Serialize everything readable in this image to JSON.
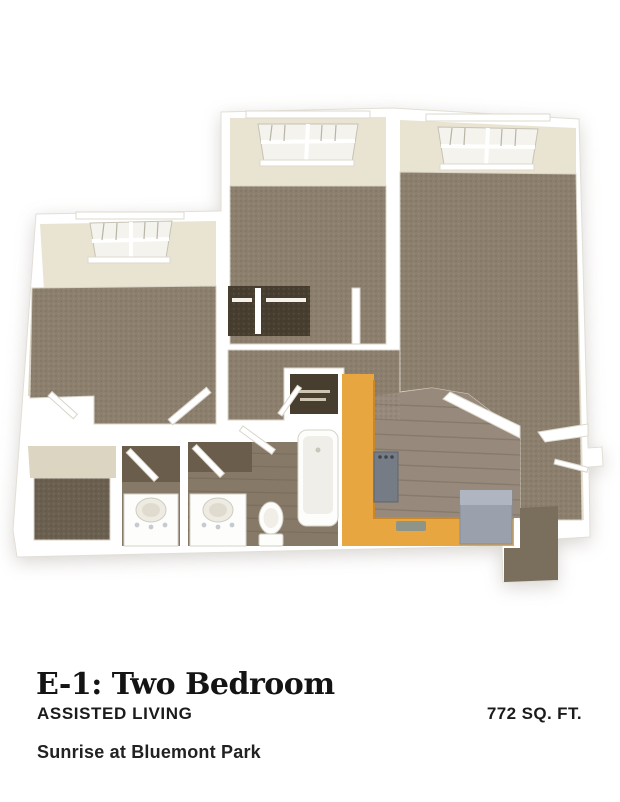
{
  "details": {
    "plan_name": "E-1: Two Bedroom",
    "plan_type": "ASSISTED LIVING",
    "area": "772 SQ. FT.",
    "community": "Sunrise at Bluemont Park"
  },
  "floor_plan": {
    "description": "3D floor plan: two carpeted bedrooms with windows, great room, hallway closets, two bathrooms with vanities, toilet and bathtub, kitchen with orange cabinets and refrigerator, entry landing",
    "colors": {
      "wall_white": "#FFFFFF",
      "wall_face": "#E9E3D2",
      "wall_face_shadow": "#DCD5C1",
      "carpet": "#8C7F6D",
      "carpet_dark": "#6B6050",
      "landing_carpet": "#7A6F5D",
      "wood_floor": "#97897B",
      "bath_wood": "#877968",
      "bath_wall_shadow": "#6A5D4B",
      "closet_dark": "#473E30",
      "cabinet_orange": "#E8A640",
      "cabinet_orange_edge": "#C9882A",
      "appliance_gray": "#9AA1AD",
      "appliance_gray_light": "#AFB6C1",
      "stove_gray": "#767C86",
      "glass": "#F4F3EE",
      "fixture_white": "#FDFDFB"
    }
  }
}
